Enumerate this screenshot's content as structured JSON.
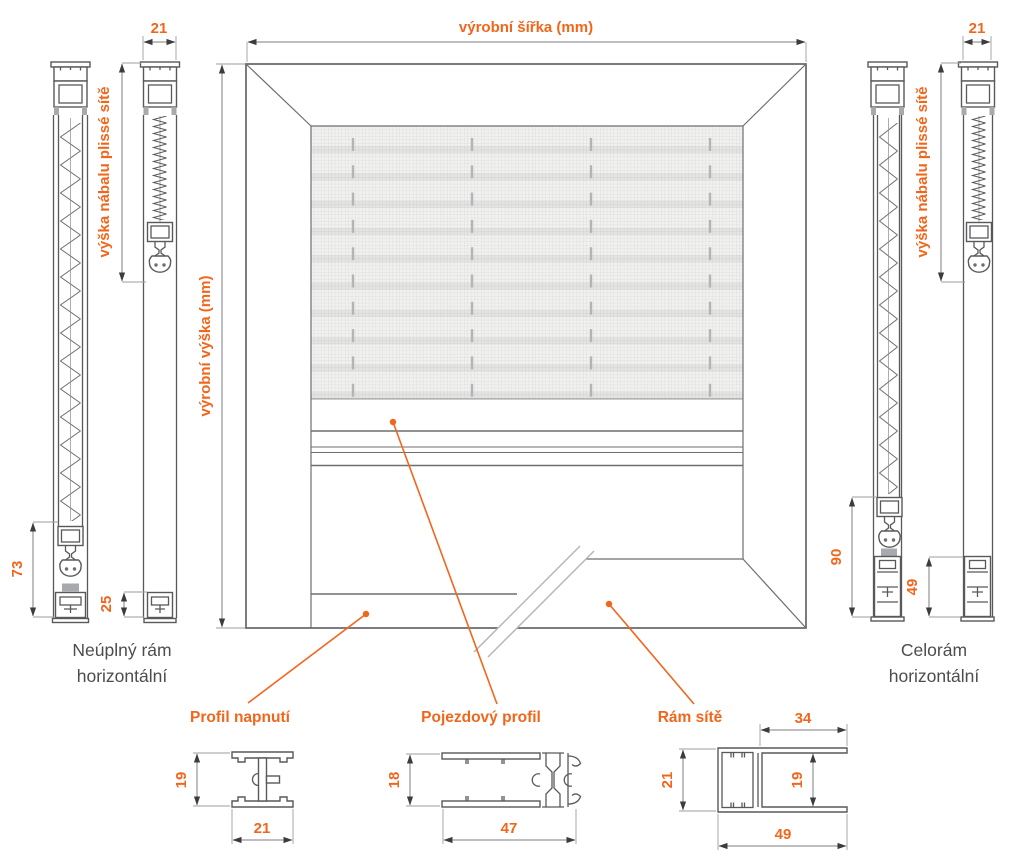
{
  "colors": {
    "accent": "#f2661c",
    "drawing_line": "#6d6e71",
    "profile_line": "#58595b",
    "text_dark": "#4d4d4f"
  },
  "frame_drawing": {
    "width_dim_label": "výrobní šířka (mm)",
    "height_dim_label": "výrobní výška (mm)"
  },
  "left_assembly": {
    "title_line1": "Neúplný rám",
    "title_line2": "horizontální",
    "top_width_mm": "21",
    "stack_height_label": "výška nábalu plissé sítě",
    "stack_total_mm": "73",
    "bottom_profile_mm": "25"
  },
  "right_assembly": {
    "title_line1": "Celorám",
    "title_line2": "horizontální",
    "top_width_mm": "21",
    "stack_height_label": "výška nábalu plissé sítě",
    "stack_total_mm": "90",
    "bottom_profile_mm": "49"
  },
  "cross_sections": {
    "tension_profile": {
      "label": "Profil napnutí",
      "height_mm": "19",
      "width_mm": "21"
    },
    "travel_profile": {
      "label": "Pojezdový profil",
      "height_mm": "18",
      "width_mm": "47"
    },
    "mesh_frame": {
      "label": "Rám sítě",
      "top_flange_mm": "34",
      "height_mm": "21",
      "inner_gap_mm": "19",
      "width_mm": "49"
    }
  }
}
